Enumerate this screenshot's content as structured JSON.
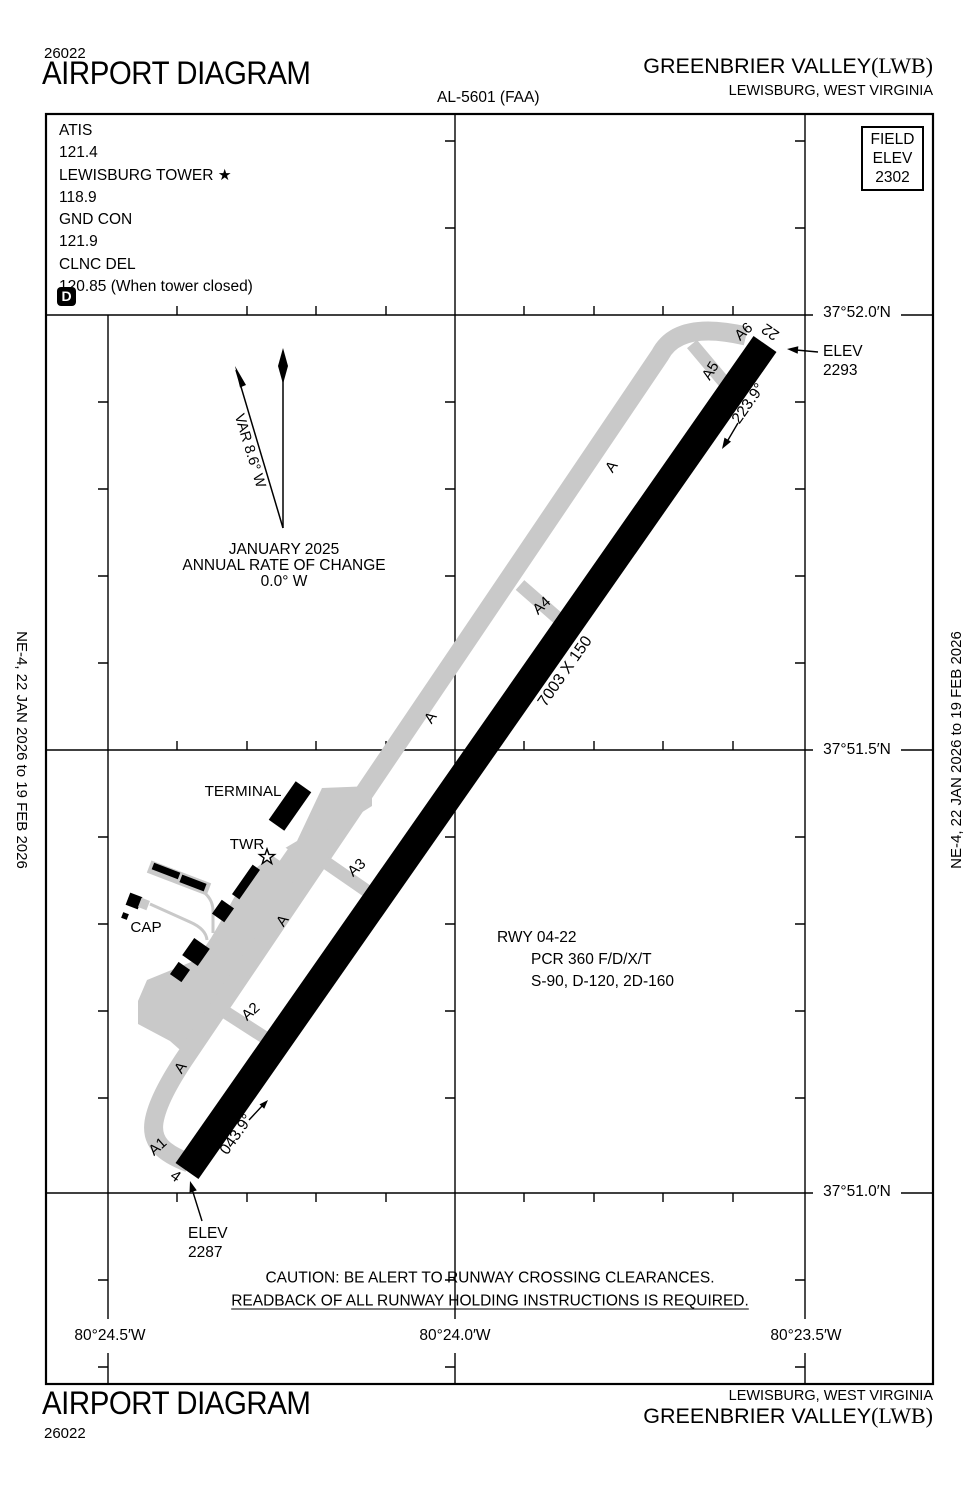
{
  "header": {
    "chart_code": "26022",
    "title": "AIRPORT DIAGRAM",
    "al_number": "AL-5601 (FAA)",
    "airport_name": "GREENBRIER VALLEY",
    "airport_id": "(LWB)",
    "city": "LEWISBURG, WEST VIRGINIA"
  },
  "comm": {
    "lines": [
      "ATIS",
      "121.4",
      "LEWISBURG TOWER ★",
      "118.9",
      "GND CON",
      "121.9",
      "CLNC DEL",
      "120.85 (When tower closed)"
    ],
    "datis": "D"
  },
  "field_elev": {
    "lines": [
      "FIELD",
      "ELEV",
      "2302"
    ]
  },
  "grid": {
    "lat": [
      "37°52.0′N",
      "37°51.5′N",
      "37°51.0′N"
    ],
    "lon": [
      "80°24.5′W",
      "80°24.0′W",
      "80°23.5′W"
    ]
  },
  "north": {
    "variation": "VAR 8.6° W",
    "date": "JANUARY 2025",
    "annual": "ANNUAL RATE OF CHANGE",
    "rate": "0.0° W"
  },
  "runway": {
    "dimensions": "7003 X 150",
    "number_ne": "22",
    "number_sw": "4",
    "heading_ne": "223.9°",
    "heading_sw": "043.9°"
  },
  "elevations": {
    "ne_label": "ELEV",
    "ne_value": "2293",
    "sw_label": "ELEV",
    "sw_value": "2287"
  },
  "rwy_info": {
    "line1": "RWY 04-22",
    "line2": "PCR 360 F/D/X/T",
    "line3": "S-90, D-120, 2D-160"
  },
  "taxi": {
    "parallel": "A",
    "a1": "A1",
    "a2": "A2",
    "a3": "A3",
    "a4": "A4",
    "a5": "A5",
    "a6": "A6"
  },
  "facilities": {
    "terminal": "TERMINAL",
    "tower": "TWR",
    "cap": "CAP"
  },
  "caution": {
    "line1": "CAUTION: BE ALERT TO RUNWAY CROSSING CLEARANCES.",
    "line2": "READBACK OF ALL RUNWAY HOLDING INSTRUCTIONS IS REQUIRED."
  },
  "sides": {
    "left": "NE-4,  22 JAN 2026  to  19 FEB 2026",
    "right": "NE-4,  22 JAN 2026  to  19 FEB 2026"
  },
  "footer": {
    "title": "AIRPORT DIAGRAM",
    "chart_code": "26022",
    "city": "LEWISBURG, WEST VIRGINIA",
    "airport_name": "GREENBRIER VALLEY",
    "airport_id": "(LWB)"
  },
  "colors": {
    "pavement": "#c9c9c9",
    "ink": "#000000"
  }
}
